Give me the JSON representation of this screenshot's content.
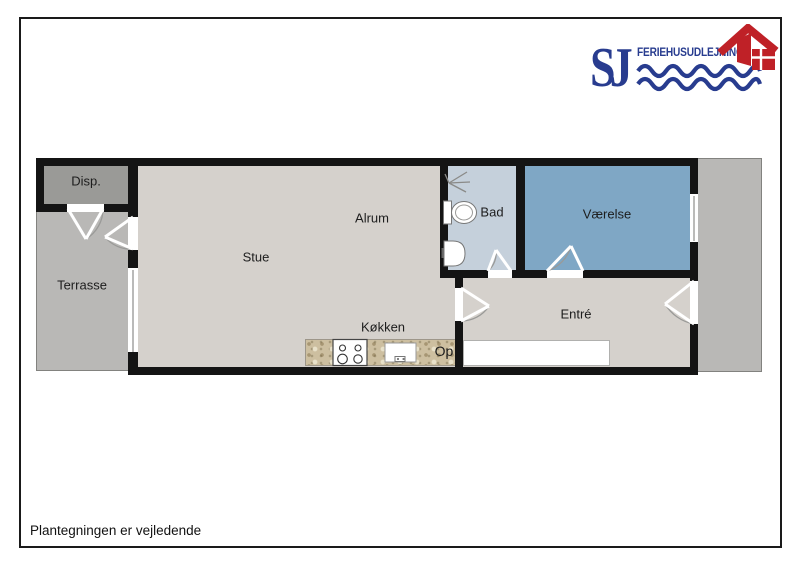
{
  "logo": {
    "initials": "SJ",
    "company": "FERIEHUSUDLEJNING",
    "colors": {
      "navy": "#283c8f",
      "red": "#bf2127"
    },
    "icons": [
      "waves-icon",
      "house-icon"
    ]
  },
  "plan": {
    "rooms": [
      {
        "id": "disp",
        "label": "Disp."
      },
      {
        "id": "terrasse",
        "label": "Terrasse"
      },
      {
        "id": "stue",
        "label": "Stue"
      },
      {
        "id": "alrum",
        "label": "Alrum"
      },
      {
        "id": "bad",
        "label": "Bad"
      },
      {
        "id": "vaerelse",
        "label": "Værelse"
      },
      {
        "id": "entre",
        "label": "Entré"
      },
      {
        "id": "koekken",
        "label": "Køkken"
      },
      {
        "id": "op",
        "label": "Op"
      }
    ],
    "colors": {
      "floor": "#d5d1cc",
      "outdoor": "#b9b8b6",
      "disp": "#9a9a97",
      "bad": "#c5d0db",
      "vaerelse": "#7fa7c5",
      "wall": "#141414",
      "counter": "#cdbfa0"
    },
    "fixtures": [
      "shower-icon",
      "toilet-icon",
      "washbasin-icon",
      "stove-icon",
      "kitchen-sink-icon"
    ]
  },
  "footer": {
    "disclaimer": "Plantegningen er vejledende"
  }
}
